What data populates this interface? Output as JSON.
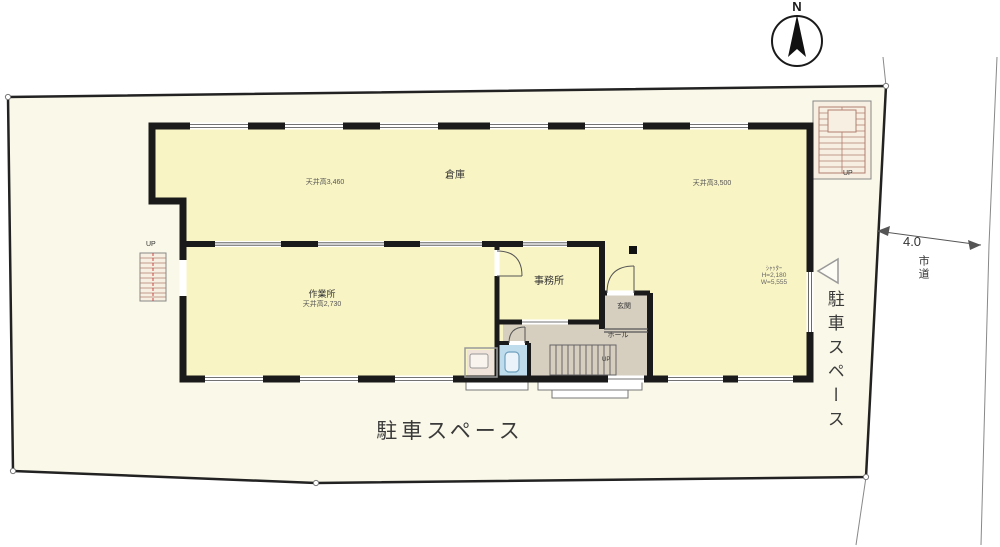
{
  "labels": {
    "north": "N",
    "road_width": "4.0",
    "road_name": "市道",
    "parking_bottom": "駐車スペース",
    "parking_right": "駐車スペース"
  },
  "rooms": {
    "warehouse": {
      "name": "倉庫",
      "ceiling_left": "天井高3,460",
      "ceiling_right": "天井高3,500"
    },
    "workshop": {
      "name": "作業所",
      "ceiling": "天井高2,730"
    },
    "office": {
      "name": "事務所"
    },
    "entrance": {
      "name": "玄関"
    },
    "hall": {
      "name": "ホール"
    }
  },
  "stairs": {
    "left_up": "UP",
    "right_up": "UP",
    "hall_up": "UP"
  },
  "shutter": {
    "line1": "ｼｬｯﾀｰ",
    "line2": "H=2,180",
    "line3": "W=5,555"
  },
  "colors": {
    "site_fill": "#FAF8E8",
    "room_fill": "#F9F4C4",
    "gray_floor": "#D6CFC0",
    "toilet_floor": "#BFDCEC",
    "washroom_floor": "#F0E4DA",
    "wall": "#1A1A1A",
    "stair_fill": "#F7EFE1",
    "stair_line": "#B07F6F"
  }
}
